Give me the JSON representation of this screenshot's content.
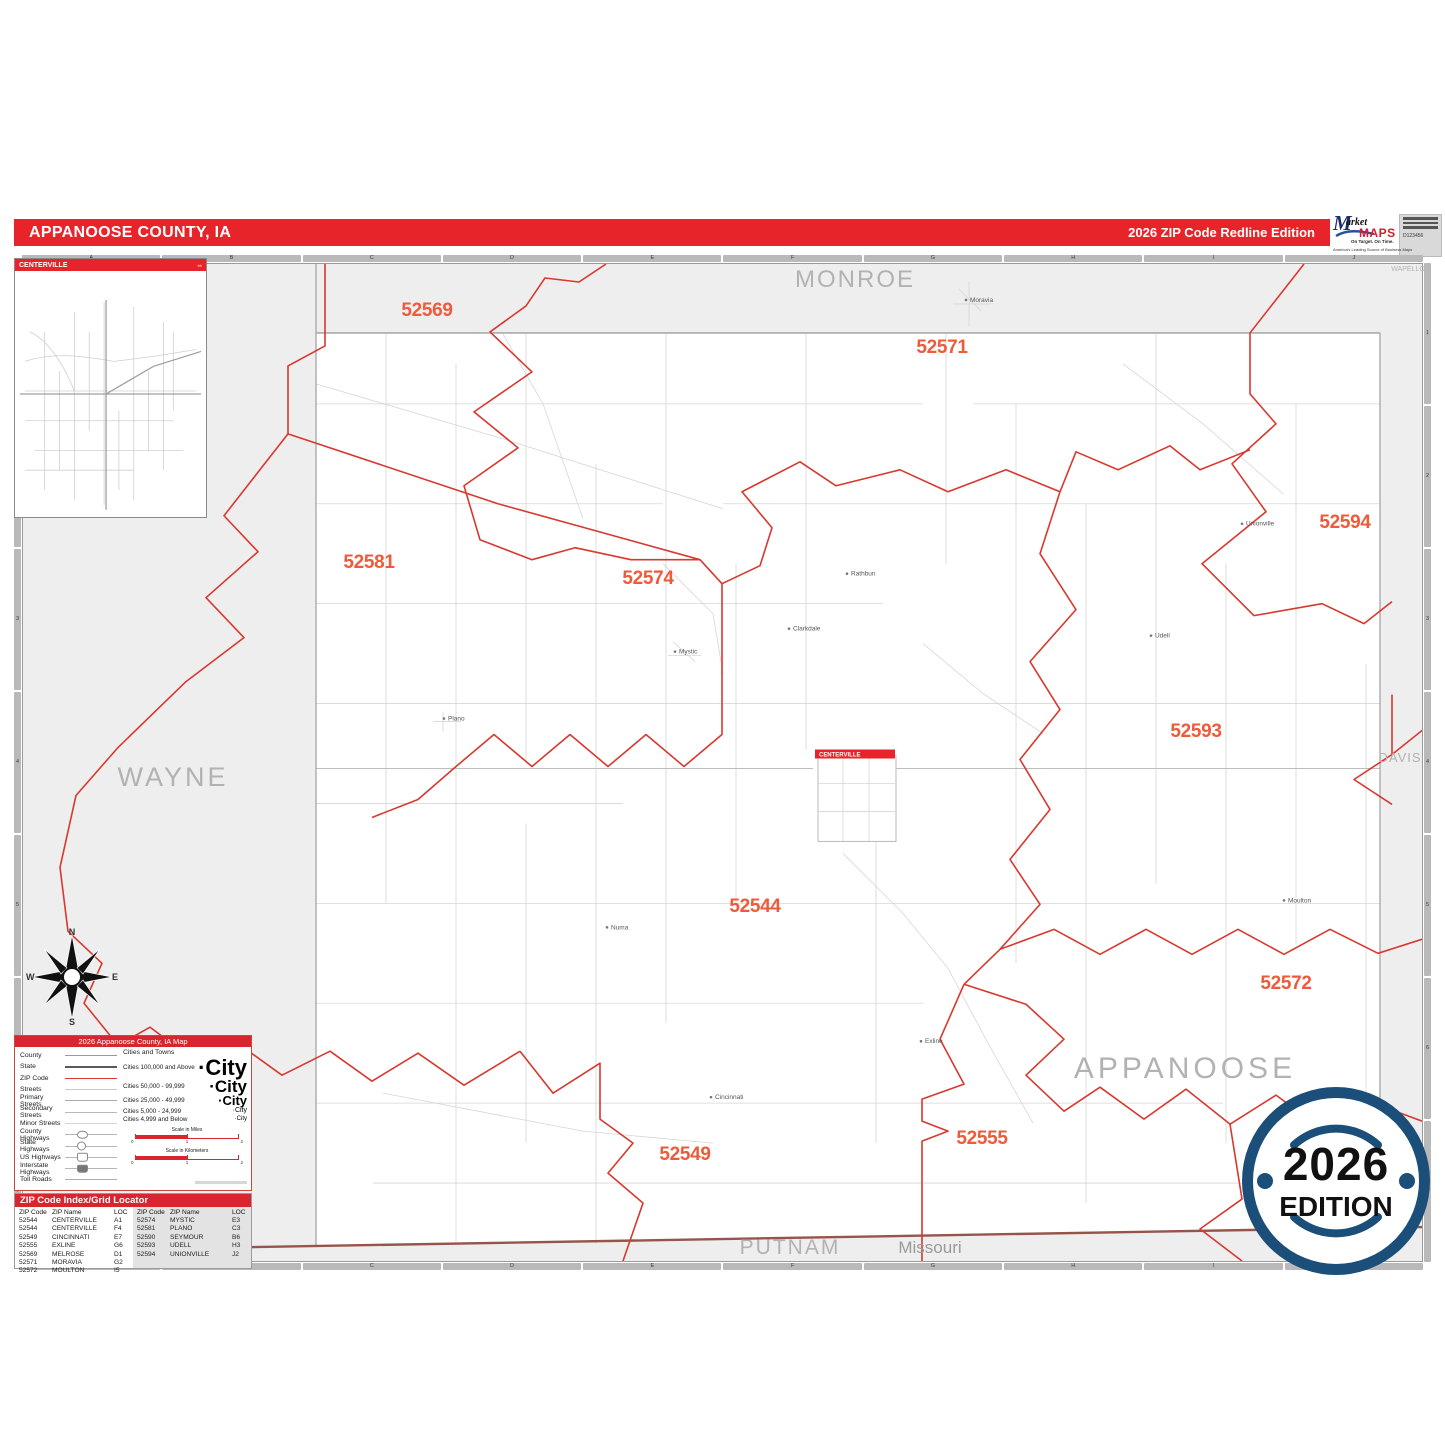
{
  "header": {
    "title": "APPANOOSE COUNTY, IA",
    "edition": "2026 ZIP Code Redline Edition"
  },
  "logo": {
    "m": "M",
    "market_rest": "arket",
    "maps": "MAPS",
    "tagline1": "On Target.  On Time.",
    "tagline2": "America's Leading Source of Business Maps",
    "product_code": "D123456"
  },
  "inset": {
    "title": "CENTERVILLE"
  },
  "grid": {
    "columns": [
      "A",
      "B",
      "C",
      "D",
      "E",
      "F",
      "G",
      "H",
      "I",
      "J"
    ],
    "rows": [
      "1",
      "2",
      "3",
      "4",
      "5",
      "6",
      "7"
    ]
  },
  "map": {
    "zips": [
      "52569",
      "52571",
      "52594",
      "52581",
      "52574",
      "52593",
      "52544",
      "52572",
      "52555",
      "52549"
    ],
    "county_labels": {
      "monroe": "MONROE",
      "wapello": "WAPELLO",
      "wayne": "WAYNE",
      "davis": "DAVIS",
      "appanoose": "APPANOOSE",
      "putnam": "PUTNAM",
      "missouri": "Missouri"
    },
    "city_box_label": "CENTERVILLE",
    "towns": [
      "Moravia",
      "Rathbun",
      "Clarkdale",
      "Mystic",
      "Plano",
      "Numa",
      "Exline",
      "Cincinnati",
      "Moulton",
      "Udell",
      "Unionville"
    ]
  },
  "compass": {
    "n": "N",
    "e": "E",
    "s": "S",
    "w": "W"
  },
  "legend": {
    "title": "2026 Appanoose County, IA Map",
    "items": [
      "County",
      "State",
      "ZIP Code",
      "Streets",
      "Primary Streets",
      "Secondary Streets",
      "Minor Streets",
      "County Highways",
      "State Highways",
      "US Highways",
      "Interstate Highways",
      "Toll Roads"
    ],
    "cities_header": "Cities and Towns",
    "city_classes": [
      {
        "label": "Cities 100,000 and Above",
        "sample": "·City"
      },
      {
        "label": "Cities 50,000 - 99,999",
        "sample": "·City"
      },
      {
        "label": "Cities 25,000 - 49,999",
        "sample": "·City"
      },
      {
        "label": "Cities 5,000 - 24,999",
        "sample": "·City"
      },
      {
        "label": "Cities 4,999 and Below",
        "sample": "·City"
      }
    ],
    "scale_miles": {
      "title": "Scale in Miles",
      "ticks": [
        "0",
        "1",
        "2"
      ]
    },
    "scale_km": {
      "title": "Scale in Kilometers",
      "ticks": [
        "0",
        "1",
        "2"
      ]
    }
  },
  "index": {
    "title": "ZIP Code Index/Grid Locator",
    "col_headers": [
      "ZIP Code",
      "ZIP Name",
      "LOC"
    ],
    "left_rows": [
      [
        "52544",
        "CENTERVILLE",
        "A1"
      ],
      [
        "52544",
        "CENTERVILLE",
        "F4"
      ],
      [
        "52549",
        "CINCINNATI",
        "E7"
      ],
      [
        "52555",
        "EXLINE",
        "G6"
      ],
      [
        "52569",
        "MELROSE",
        "D1"
      ],
      [
        "52571",
        "MORAVIA",
        "G2"
      ],
      [
        "52572",
        "MOULTON",
        "I5"
      ]
    ],
    "right_rows": [
      [
        "52574",
        "MYSTIC",
        "E3"
      ],
      [
        "52581",
        "PLANO",
        "C3"
      ],
      [
        "52590",
        "SEYMOUR",
        "B6"
      ],
      [
        "52593",
        "UDELL",
        "H3"
      ],
      [
        "52594",
        "UNIONVILLE",
        "J2"
      ]
    ]
  },
  "badge": {
    "year": "2026",
    "word": "EDITION"
  },
  "colors": {
    "header_red": "#E8242B",
    "zip_label_orange": "#EE5B3A",
    "zip_boundary_red": "#D8382E",
    "badge_navy": "#1B4E79",
    "out_of_county_gray": "#EEEEEF"
  }
}
